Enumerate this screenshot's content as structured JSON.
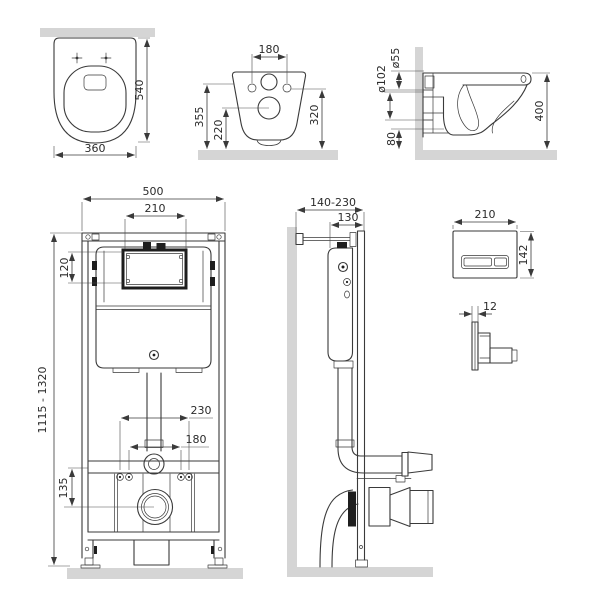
{
  "views": {
    "toilet_top": {
      "dims": {
        "height": "540",
        "width": "360"
      }
    },
    "toilet_back": {
      "dims": {
        "fixing_hole_spacing": "180",
        "height_to_top": "355",
        "height_to_outlet": "220",
        "height_right": "320"
      }
    },
    "toilet_side": {
      "dims": {
        "inlet_diameter": "ø55",
        "drain_diameter": "ø102",
        "clearance_bottom": "80",
        "depth": "400"
      }
    },
    "frame_front": {
      "dims": {
        "width": "500",
        "access_window_width": "210",
        "access_window_height": "120",
        "height_range": "1115 - 1320",
        "rod_spacing_outer": "230",
        "rod_spacing_inner": "180",
        "drain_offset": "135"
      }
    },
    "frame_side": {
      "dims": {
        "depth_range": "140-230",
        "frame_depth": "130"
      }
    },
    "flush_plate": {
      "dims": {
        "width": "210",
        "height": "142",
        "thickness": "12"
      }
    }
  },
  "colors": {
    "line": "#3a3a3a",
    "dim_text": "#2b2b2b",
    "wall_fill": "#d5d5d5",
    "dark_fill": "#1e1e1e",
    "background": "#ffffff"
  }
}
